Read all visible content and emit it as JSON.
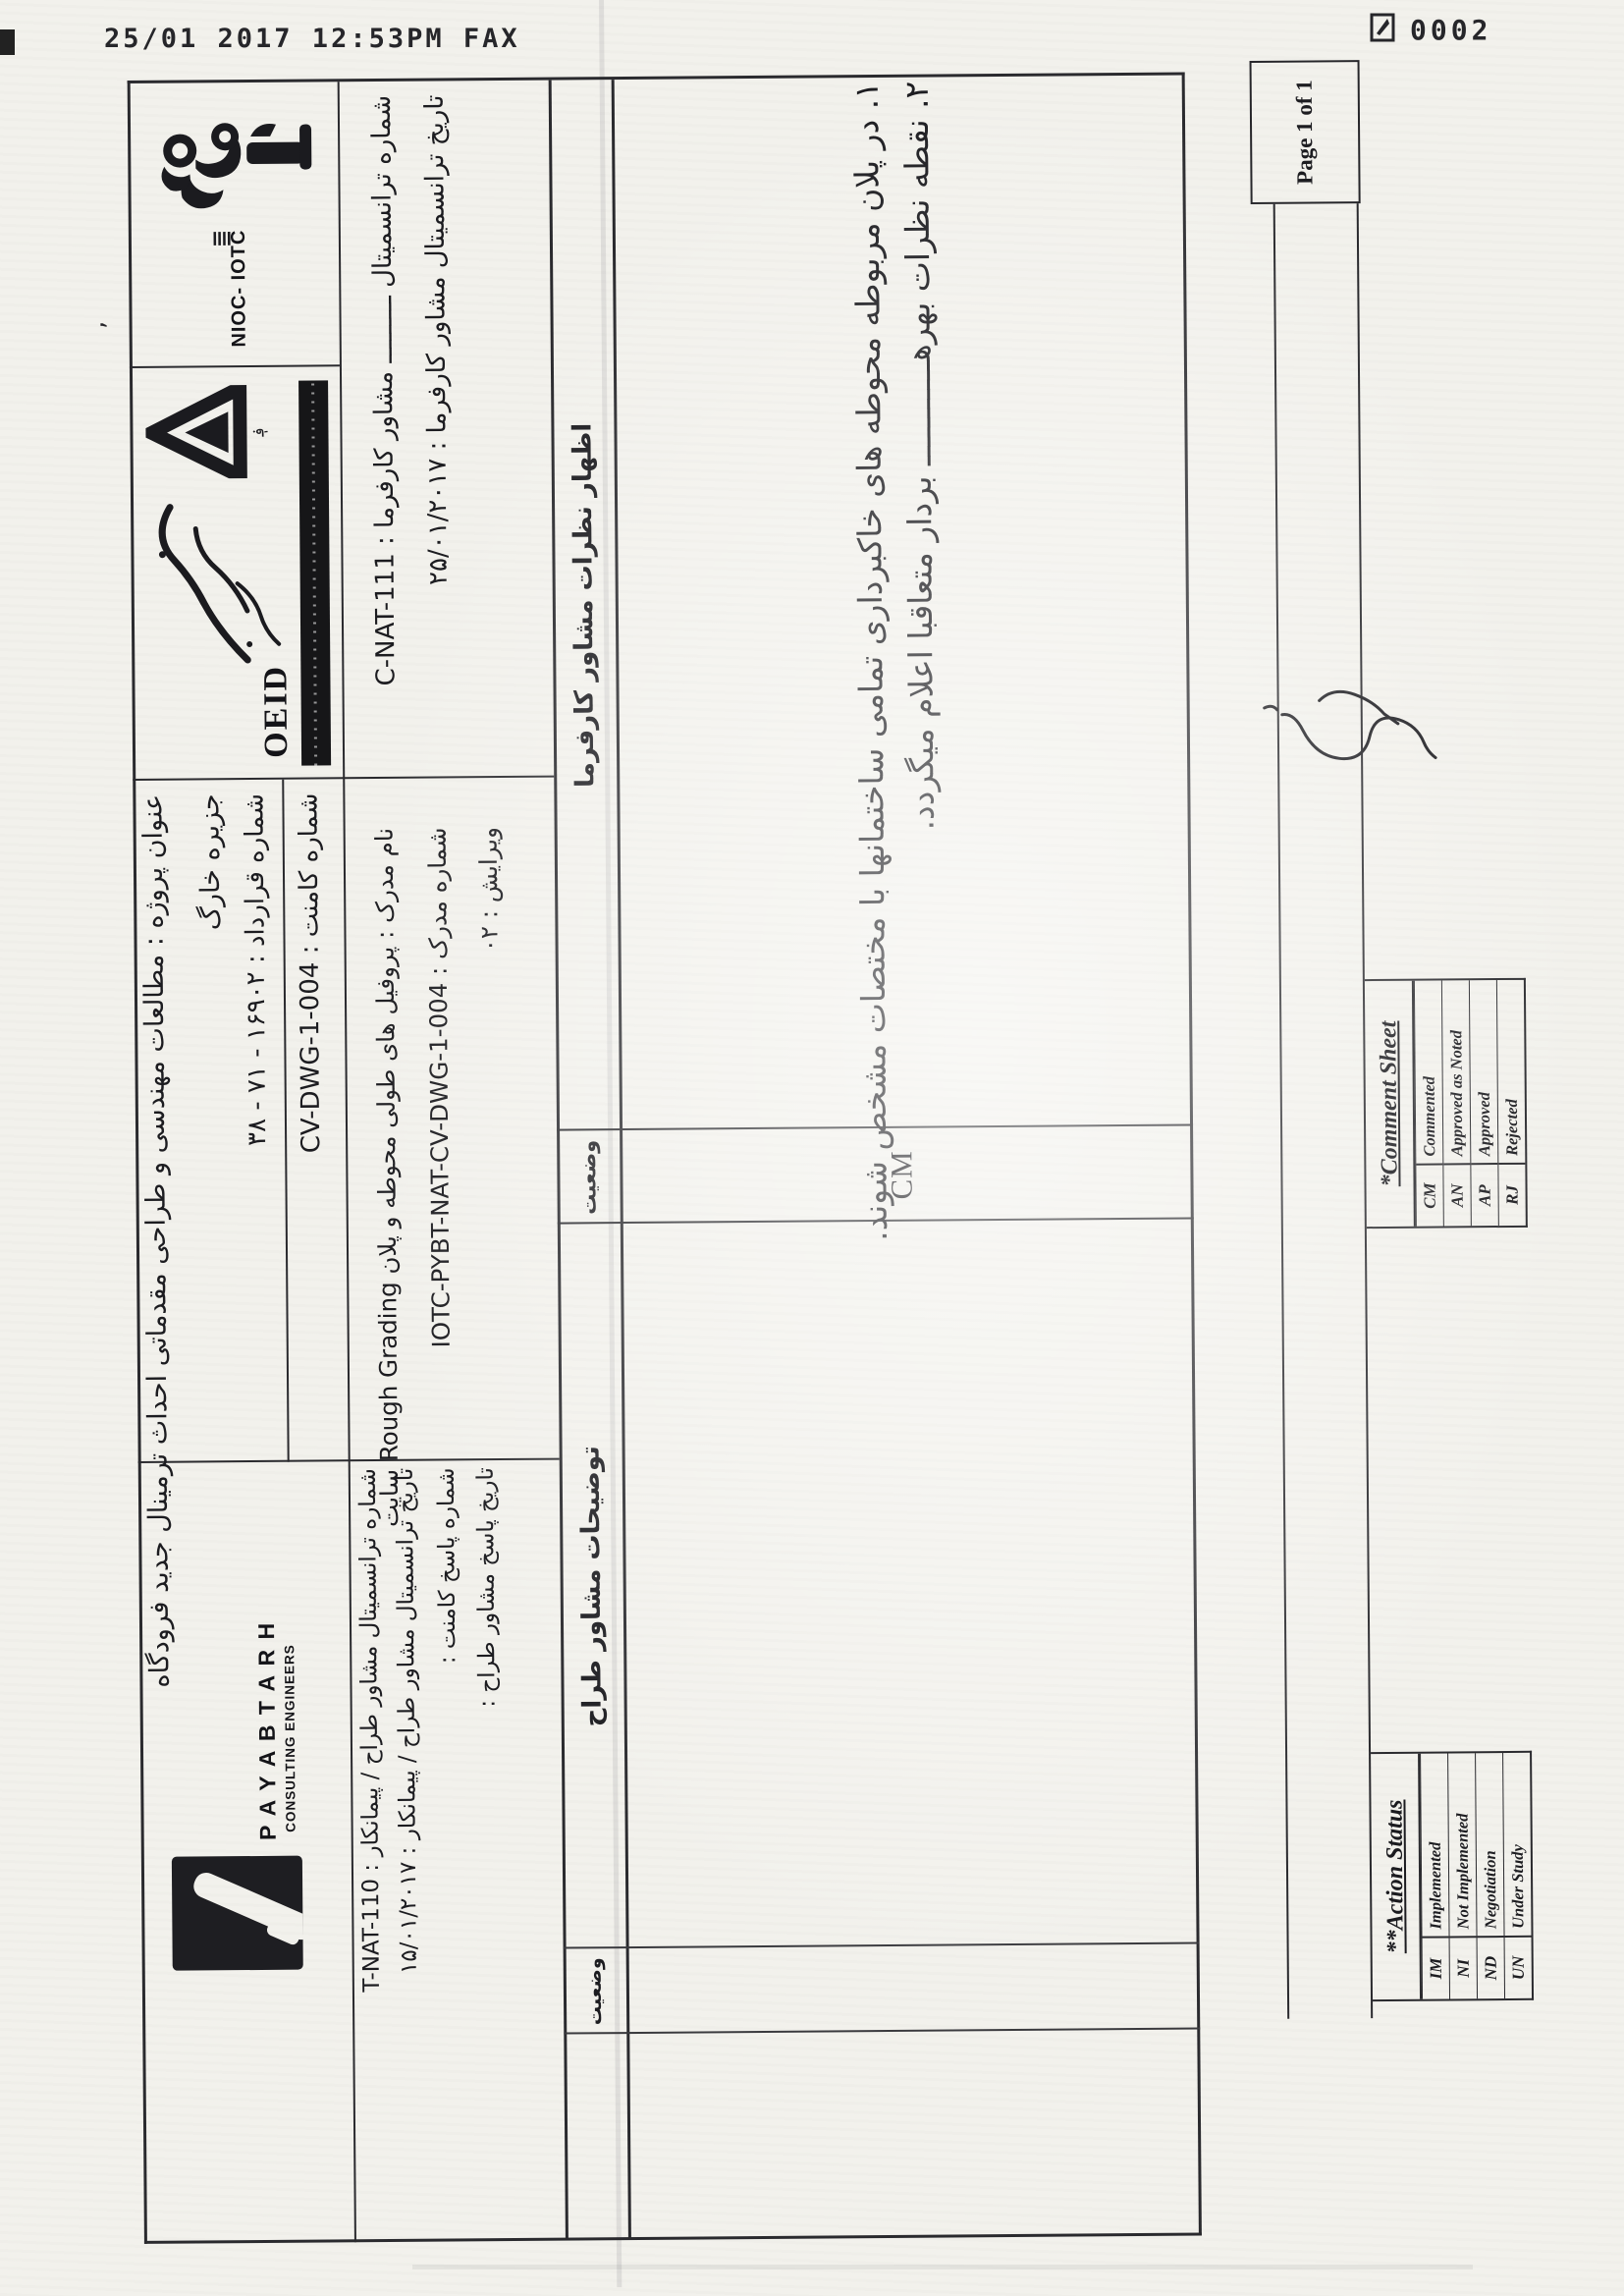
{
  "fax_header": {
    "timestamp": "25/01 2017 12:53PM FAX",
    "page_counter": "0002"
  },
  "logos": {
    "nioc_text": "NIOC- IOTC",
    "oeid_text": "OEID",
    "payabtarh_name": "P A Y A B T A R H",
    "payabtarh_sub": "CONSULTING ENGINEERS"
  },
  "title_block": {
    "project_title_line1": "عنوان پروژه : مطالعات مهندسی و طراحی مقدماتی احداث ترمینال جدید فرودگاه",
    "project_title_line2": "جزیره خارگ",
    "contract_no": "شماره قرارداد : ۱۶۹۰۲ - ۷۱ - ۳۸",
    "comment_no": "شماره کامنت : CV-DWG-1-004",
    "client_transmittal_no": "شماره ترانسمیتال ـــــــــ مشاور کارفرما : C-NAT-111",
    "client_transmittal_date": "تاریخ ترانسمیتال مشاور کارفرما : ۲۵/۰۱/۲۰۱۷",
    "designer_transmittal_no": "شماره ترانسمیتال مشاور طراح / پیمانکار : T-NAT-110",
    "designer_transmittal_date": "تاریخ ترانسمیتال مشاور طراح / پیمانکار : ۱۵/۰۱/۲۰۱۷",
    "response_no": "شماره پاسخ کامنت :",
    "response_date": "تاریخ پاسخ مشاور طراح :",
    "doc_name": "نام مدرک : پروفیل های طولی محوطه و پلان Rough Grading سایت",
    "doc_no": "شماره مدرک : IOTC-PYBT-NAT-CV-DWG-1-004",
    "revision": "ویرایش : ۰۲"
  },
  "comment_table": {
    "header_client_comments": "اظهار نظرات مشاور کارفرما",
    "header_status": "وضعیت",
    "header_designer_notes": "توضیحات مشاور طراح",
    "header_status2": "وضعیت",
    "comments": [
      "۱. در پلان مربوطه محوطه های خاکبرداری تمامی ساختمانها با مختصات مشخص شوند.",
      "۲. نقطه نظرات بهرهـــــــــــ بردار متعاقبا اعلام میگردد."
    ],
    "status_value": "CM"
  },
  "legend": {
    "comment_sheet": {
      "title": "*Comment Sheet",
      "rows": [
        {
          "code": "CM",
          "label": "Commented"
        },
        {
          "code": "AN",
          "label": "Approved as Noted"
        },
        {
          "code": "AP",
          "label": "Approved"
        },
        {
          "code": "RJ",
          "label": "Rejected"
        }
      ]
    },
    "action_status": {
      "title": "**Action Status",
      "rows": [
        {
          "code": "IM",
          "label": "Implemented"
        },
        {
          "code": "NI",
          "label": "Not Implemented"
        },
        {
          "code": "ND",
          "label": "Negotiation"
        },
        {
          "code": "UN",
          "label": "Under Study"
        }
      ]
    },
    "page_info": "Page 1 of 1"
  },
  "colors": {
    "paper": "#f2f1ec",
    "ink": "#1d1d21"
  }
}
